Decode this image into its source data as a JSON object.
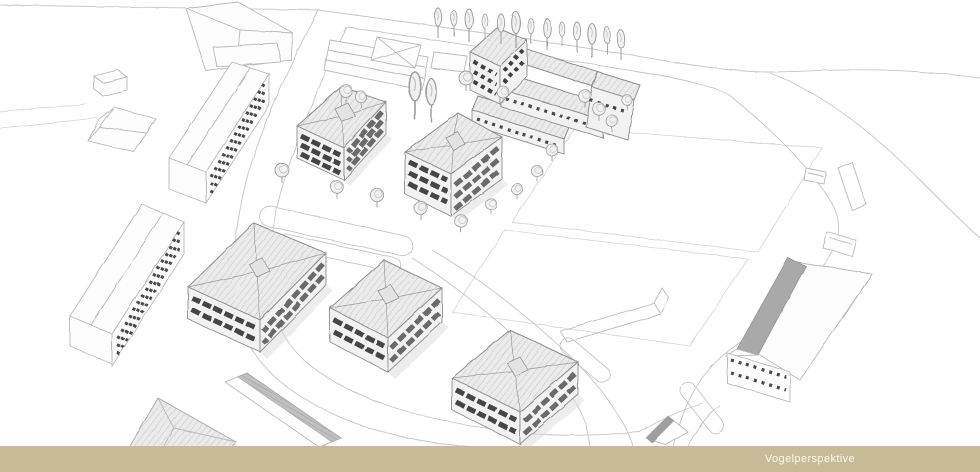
{
  "slide": {
    "background_color": "#ffffff",
    "caption_bar": {
      "label": "Vogelperspektive",
      "background_color": "#c8bb98",
      "text_color": "#faf8f0"
    },
    "drawing": {
      "kind": "pencil-style bird's-eye perspective of a residential site plan",
      "paper_color": "#ffffff",
      "sketch_line_color": "#b9b9b9",
      "window_ink_color": "#3c3c3c",
      "roof_fill_color": "#ececec"
    }
  }
}
